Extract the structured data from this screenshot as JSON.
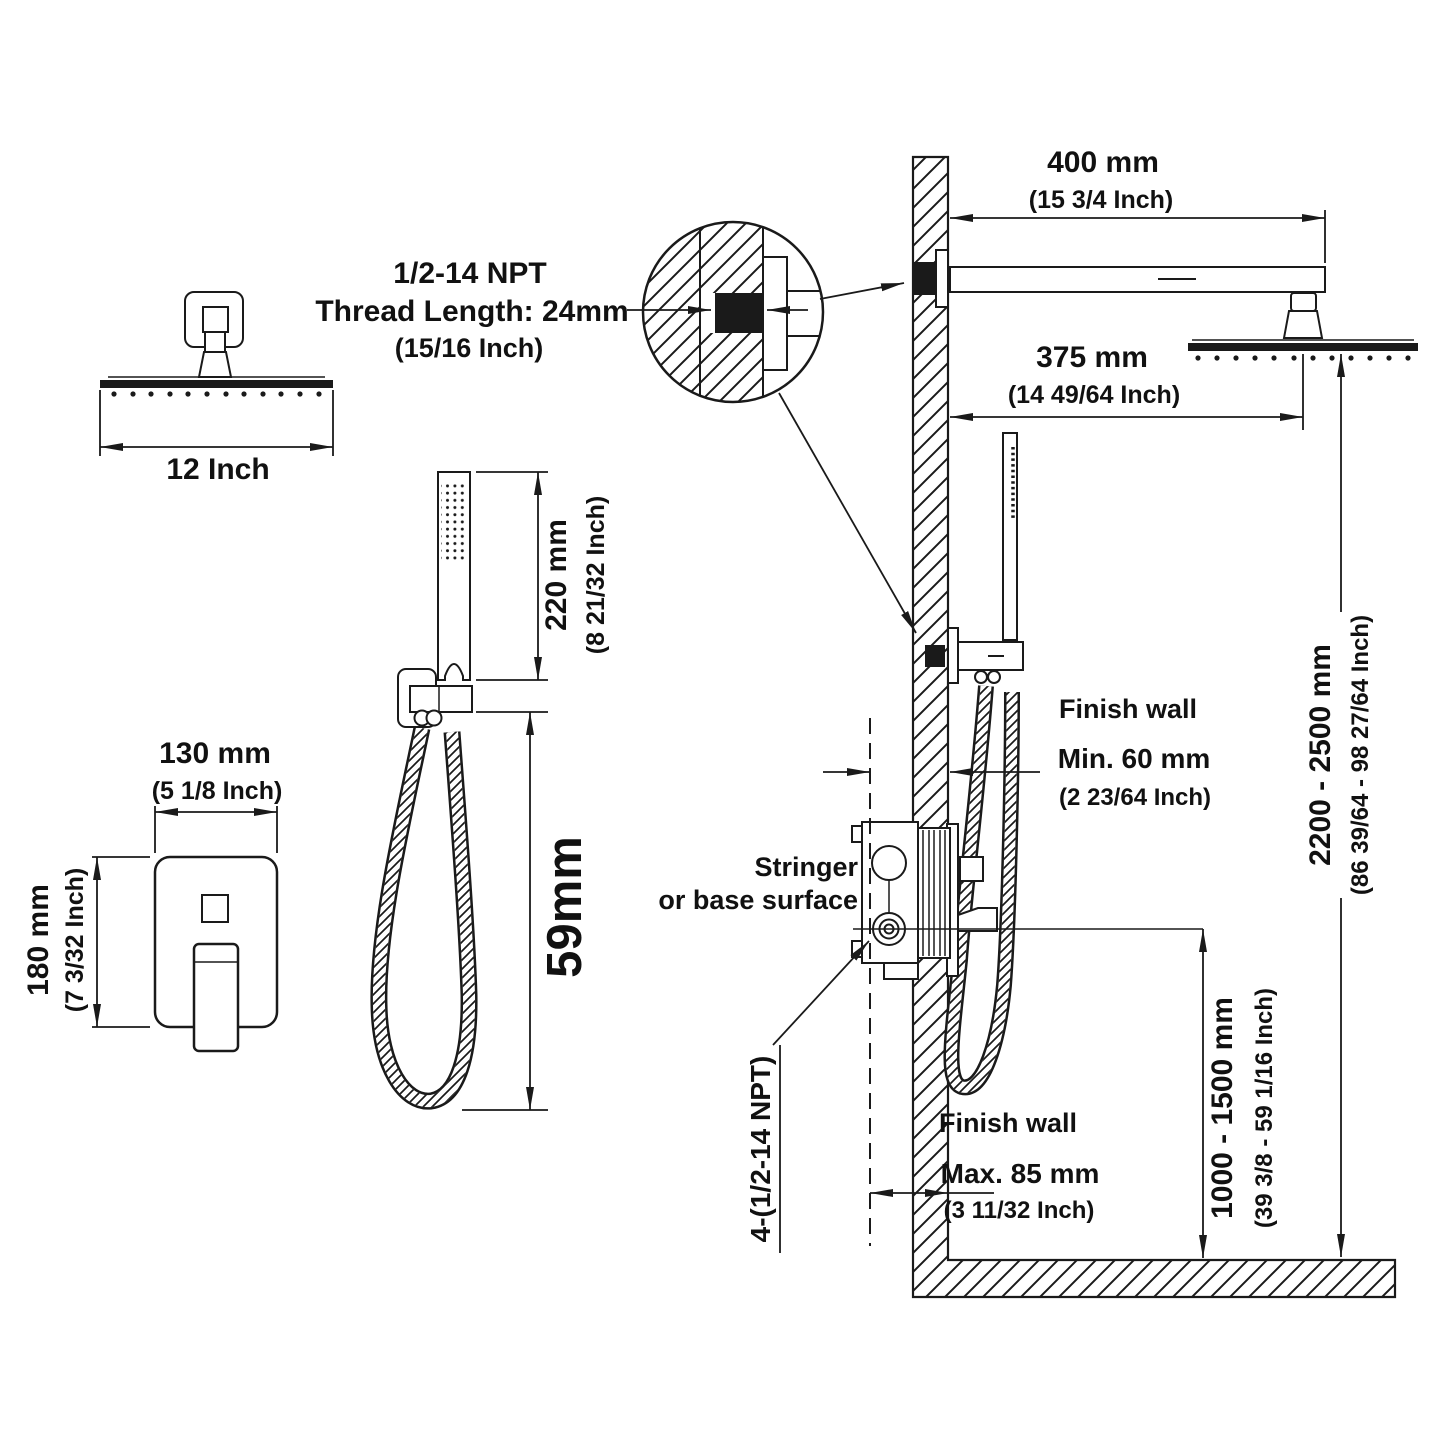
{
  "colors": {
    "background": "#ffffff",
    "line": "#1a1a1a"
  },
  "head_front": {
    "width_label": "12 Inch"
  },
  "valve_front": {
    "width_mm": "130 mm",
    "width_in": "(5 1/8 Inch)",
    "height_mm": "180 mm",
    "height_in": "(7 3/32 Inch)"
  },
  "hand_shower": {
    "length_mm": "220 mm",
    "length_in": "(8 21/32 Inch)",
    "label_59": "59mm"
  },
  "thread_detail": {
    "line1": "1/2-14 NPT",
    "line2": "Thread Length: 24mm",
    "line3": "(15/16 Inch)"
  },
  "install": {
    "arm_mm": "400 mm",
    "arm_in": "(15 3/4 Inch)",
    "offset_mm": "375 mm",
    "offset_in": "(14 49/64 Inch)",
    "height_mm": "2200 - 2500 mm",
    "height_in": "(86 39/64 - 98 27/64 Inch)",
    "vheight_mm": "1000 - 1500 mm",
    "vheight_in": "(39 3/8 - 59 1/16 Inch)",
    "fw_upper": "Finish wall",
    "min_mm": "Min. 60 mm",
    "min_in": "(2 23/64 Inch)",
    "fw_lower": "Finish wall",
    "max_mm": "Max. 85 mm",
    "max_in": "(3 11/32 Inch)",
    "stringer1": "Stringer",
    "stringer2": "or base surface",
    "npt": "4-(1/2-14 NPT)"
  }
}
